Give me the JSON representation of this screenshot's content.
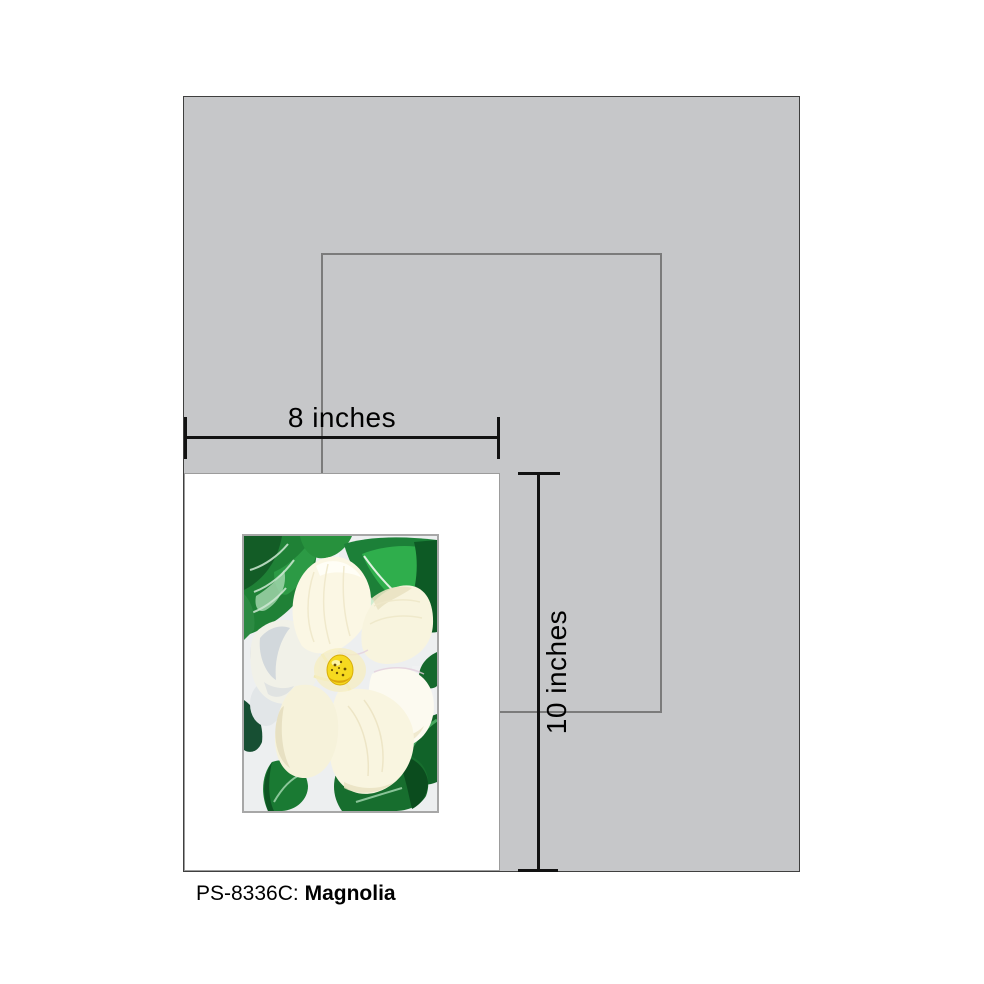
{
  "product": {
    "code": "PS-8336C:",
    "title": "Magnolia"
  },
  "dimensions": {
    "width": "8 inches",
    "height": "10 inches"
  },
  "artwork": {
    "name": "magnolia-painting",
    "description": "White magnolia blossom with yellow center and dark green leaves on a pale canvas"
  },
  "colors": {
    "mat_gray": "#c6c7c9",
    "mat_border": "#3f3f3f",
    "frame_outline_gray": "#7b7b7b",
    "print_white": "#ffffff",
    "dimension_line_black": "#121212",
    "leaf_green": "#1e8136",
    "leaf_green_dark": "#0d5a25",
    "petal_cream": "#faf6e3",
    "flower_center_yellow": "#f6d91f"
  }
}
